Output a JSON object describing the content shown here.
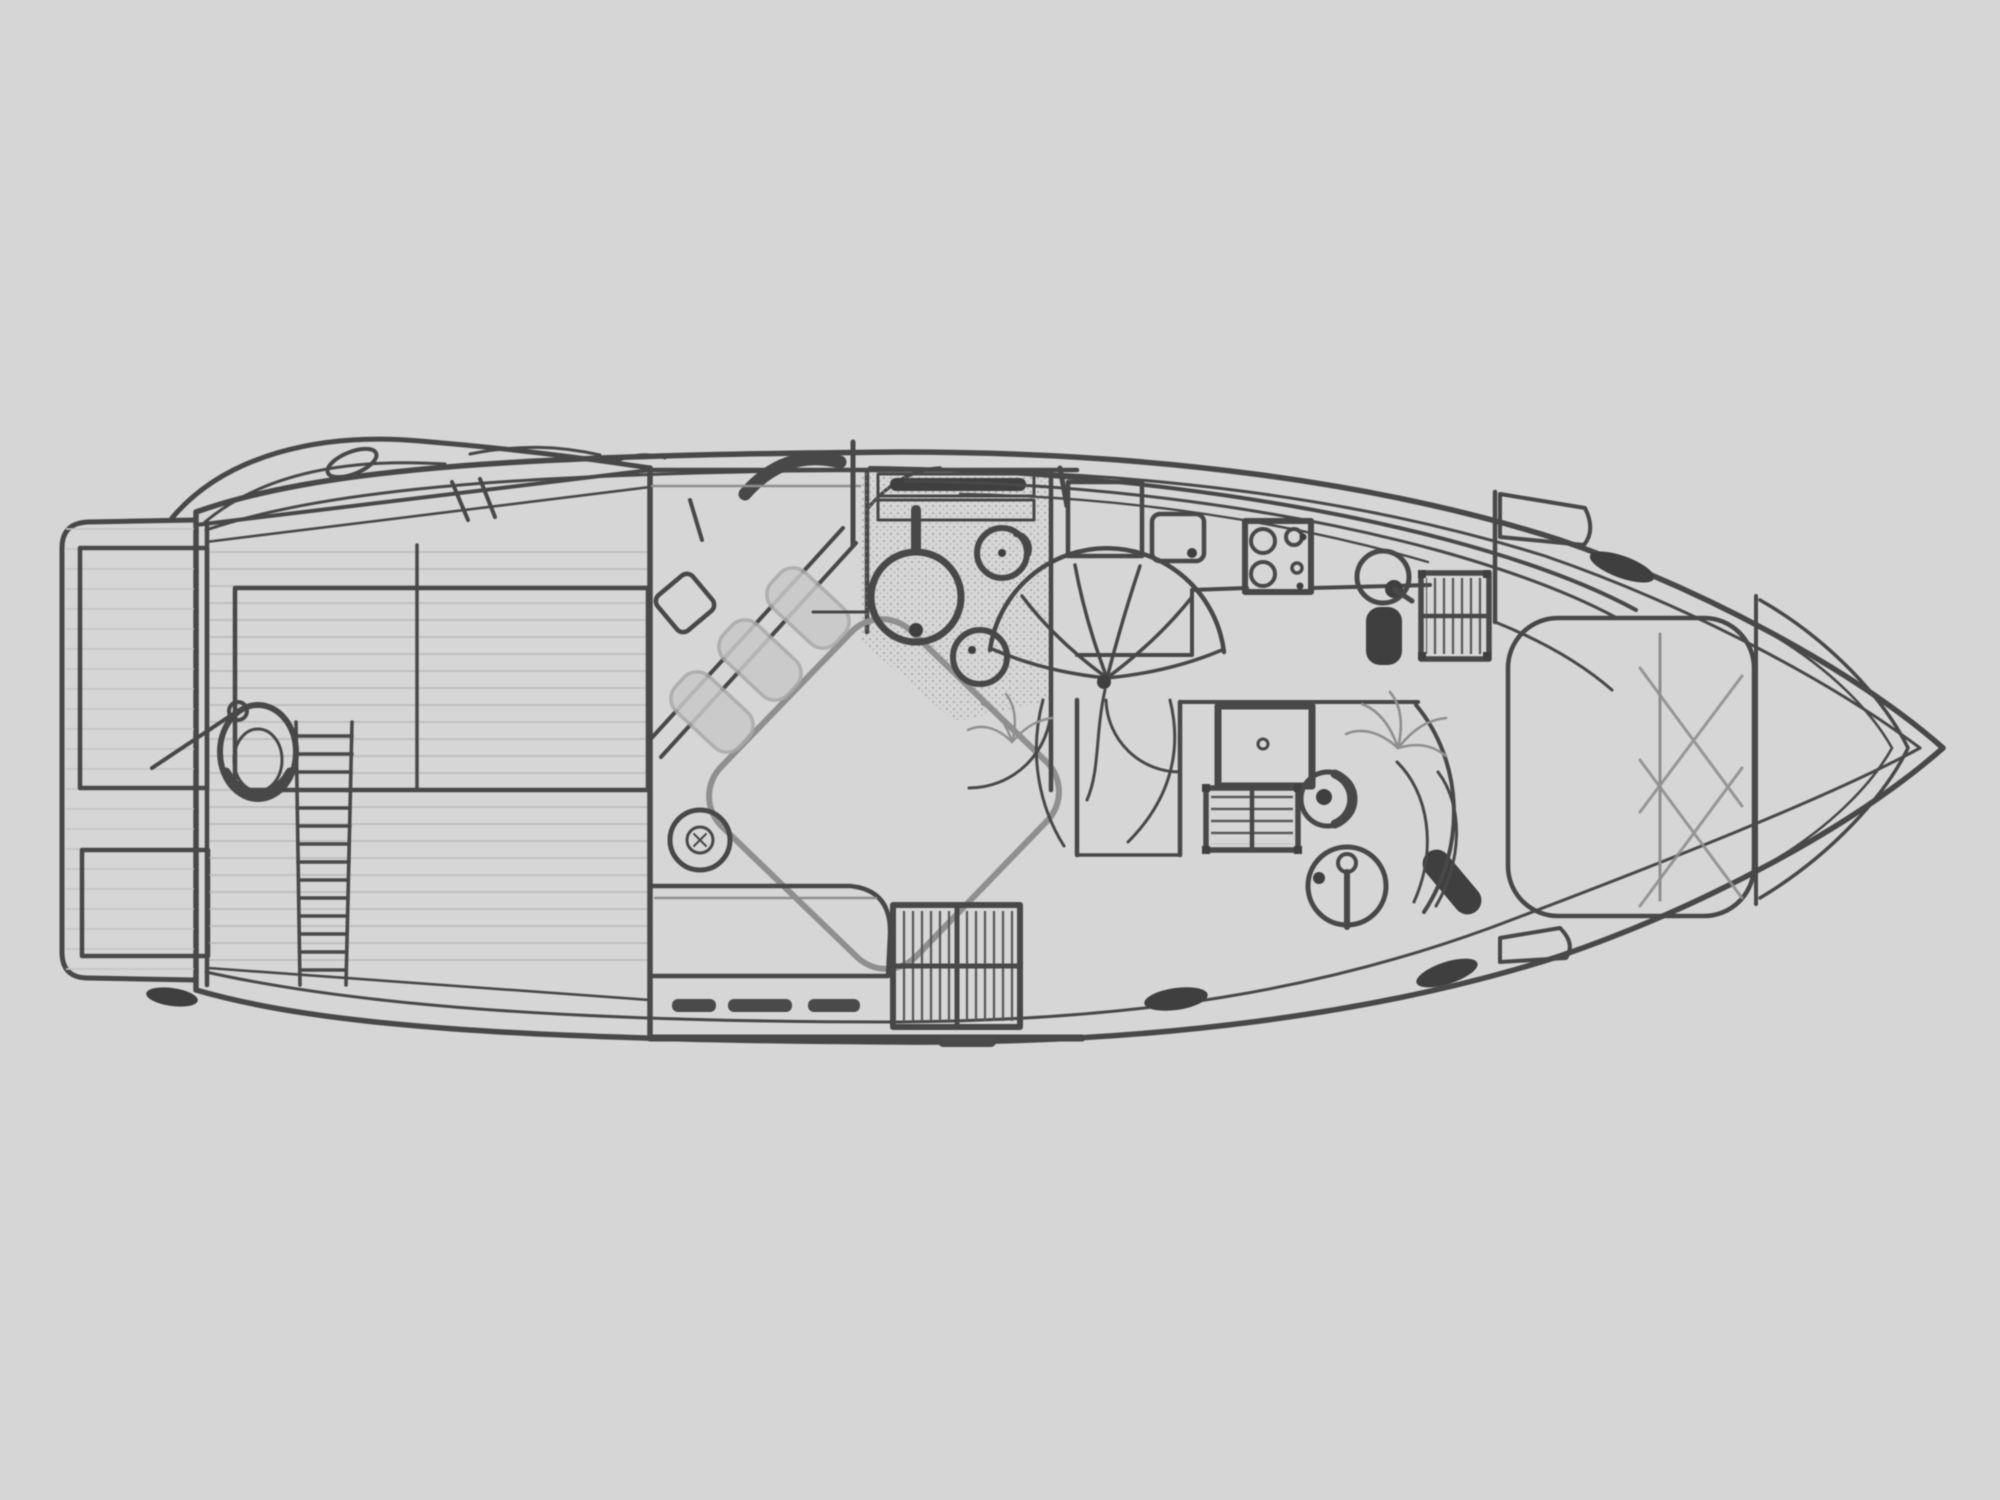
{
  "figure": {
    "kind": "yacht-deck-floor-plan",
    "orientation": "bow-right",
    "colors": {
      "background": "#d6d6d6",
      "hull_fill": "#dedede",
      "line": "#484848",
      "line_light": "#8f8f8f",
      "dark_fittings": "#3f3f3f",
      "texture": "#b5b5b5"
    },
    "areas": [
      {
        "id": "hull",
        "label": "Hull outline with transom and bow"
      },
      {
        "id": "swim-platform",
        "label": "Swim platform with transom lockers"
      },
      {
        "id": "aft-deck",
        "label": "Aft cockpit with planked sole, hatch, seat and boarding ladder"
      },
      {
        "id": "master-cabin",
        "label": "Midship cabin with diagonal double bed, pillows, stool, settee and louvred cabinet"
      },
      {
        "id": "mid-head",
        "label": "Midship bathroom with toilet, two basins and shelves"
      },
      {
        "id": "spiral-staircase",
        "label": "Curved companionway staircase"
      },
      {
        "id": "galley",
        "label": "Galley with cooktop, round sink, appliances and refrigerator"
      },
      {
        "id": "forward-head",
        "label": "Forward bathroom with shower pan, louvred locker, toilet and basin"
      },
      {
        "id": "forward-cabin",
        "label": "Forward cabin with island bed and quilted head end"
      },
      {
        "id": "bow",
        "label": "Bow with pulpit lines"
      },
      {
        "id": "deck-fittings",
        "label": "Windshield sheer lines, cleats and deck hardware"
      }
    ],
    "fixtures": {
      "aft_deck": [
        "seat-toilet-shape",
        "boarding-ladder",
        "engine-hatch",
        "support-strut"
      ],
      "master_cabin": [
        "diagonal-double-bed",
        "headboard-pillows",
        "vanity-stool",
        "round-stool",
        "settee",
        "drawer-pulls",
        "louvred-cabinet"
      ],
      "mid_head": [
        "toilet",
        "round-basin",
        "second-basin",
        "shelf-unit",
        "door-swing"
      ],
      "galley": {
        "burners_on_stove": 4,
        "items": [
          "cabinet",
          "worktop-appliance",
          "cooktop",
          "round-sink",
          "faucet",
          "waste-bin",
          "refrigerator-grid"
        ]
      },
      "forward_head": [
        "shower-pan",
        "louvred-drawer-unit",
        "toilet",
        "round-basin",
        "faucet",
        "shower-seat",
        "glass-arcs",
        "plant"
      ],
      "forward_cabin": [
        "island-bed",
        "quilted-lattice",
        "side-cabinet",
        "bulkhead"
      ],
      "cleats_count": 4
    }
  }
}
